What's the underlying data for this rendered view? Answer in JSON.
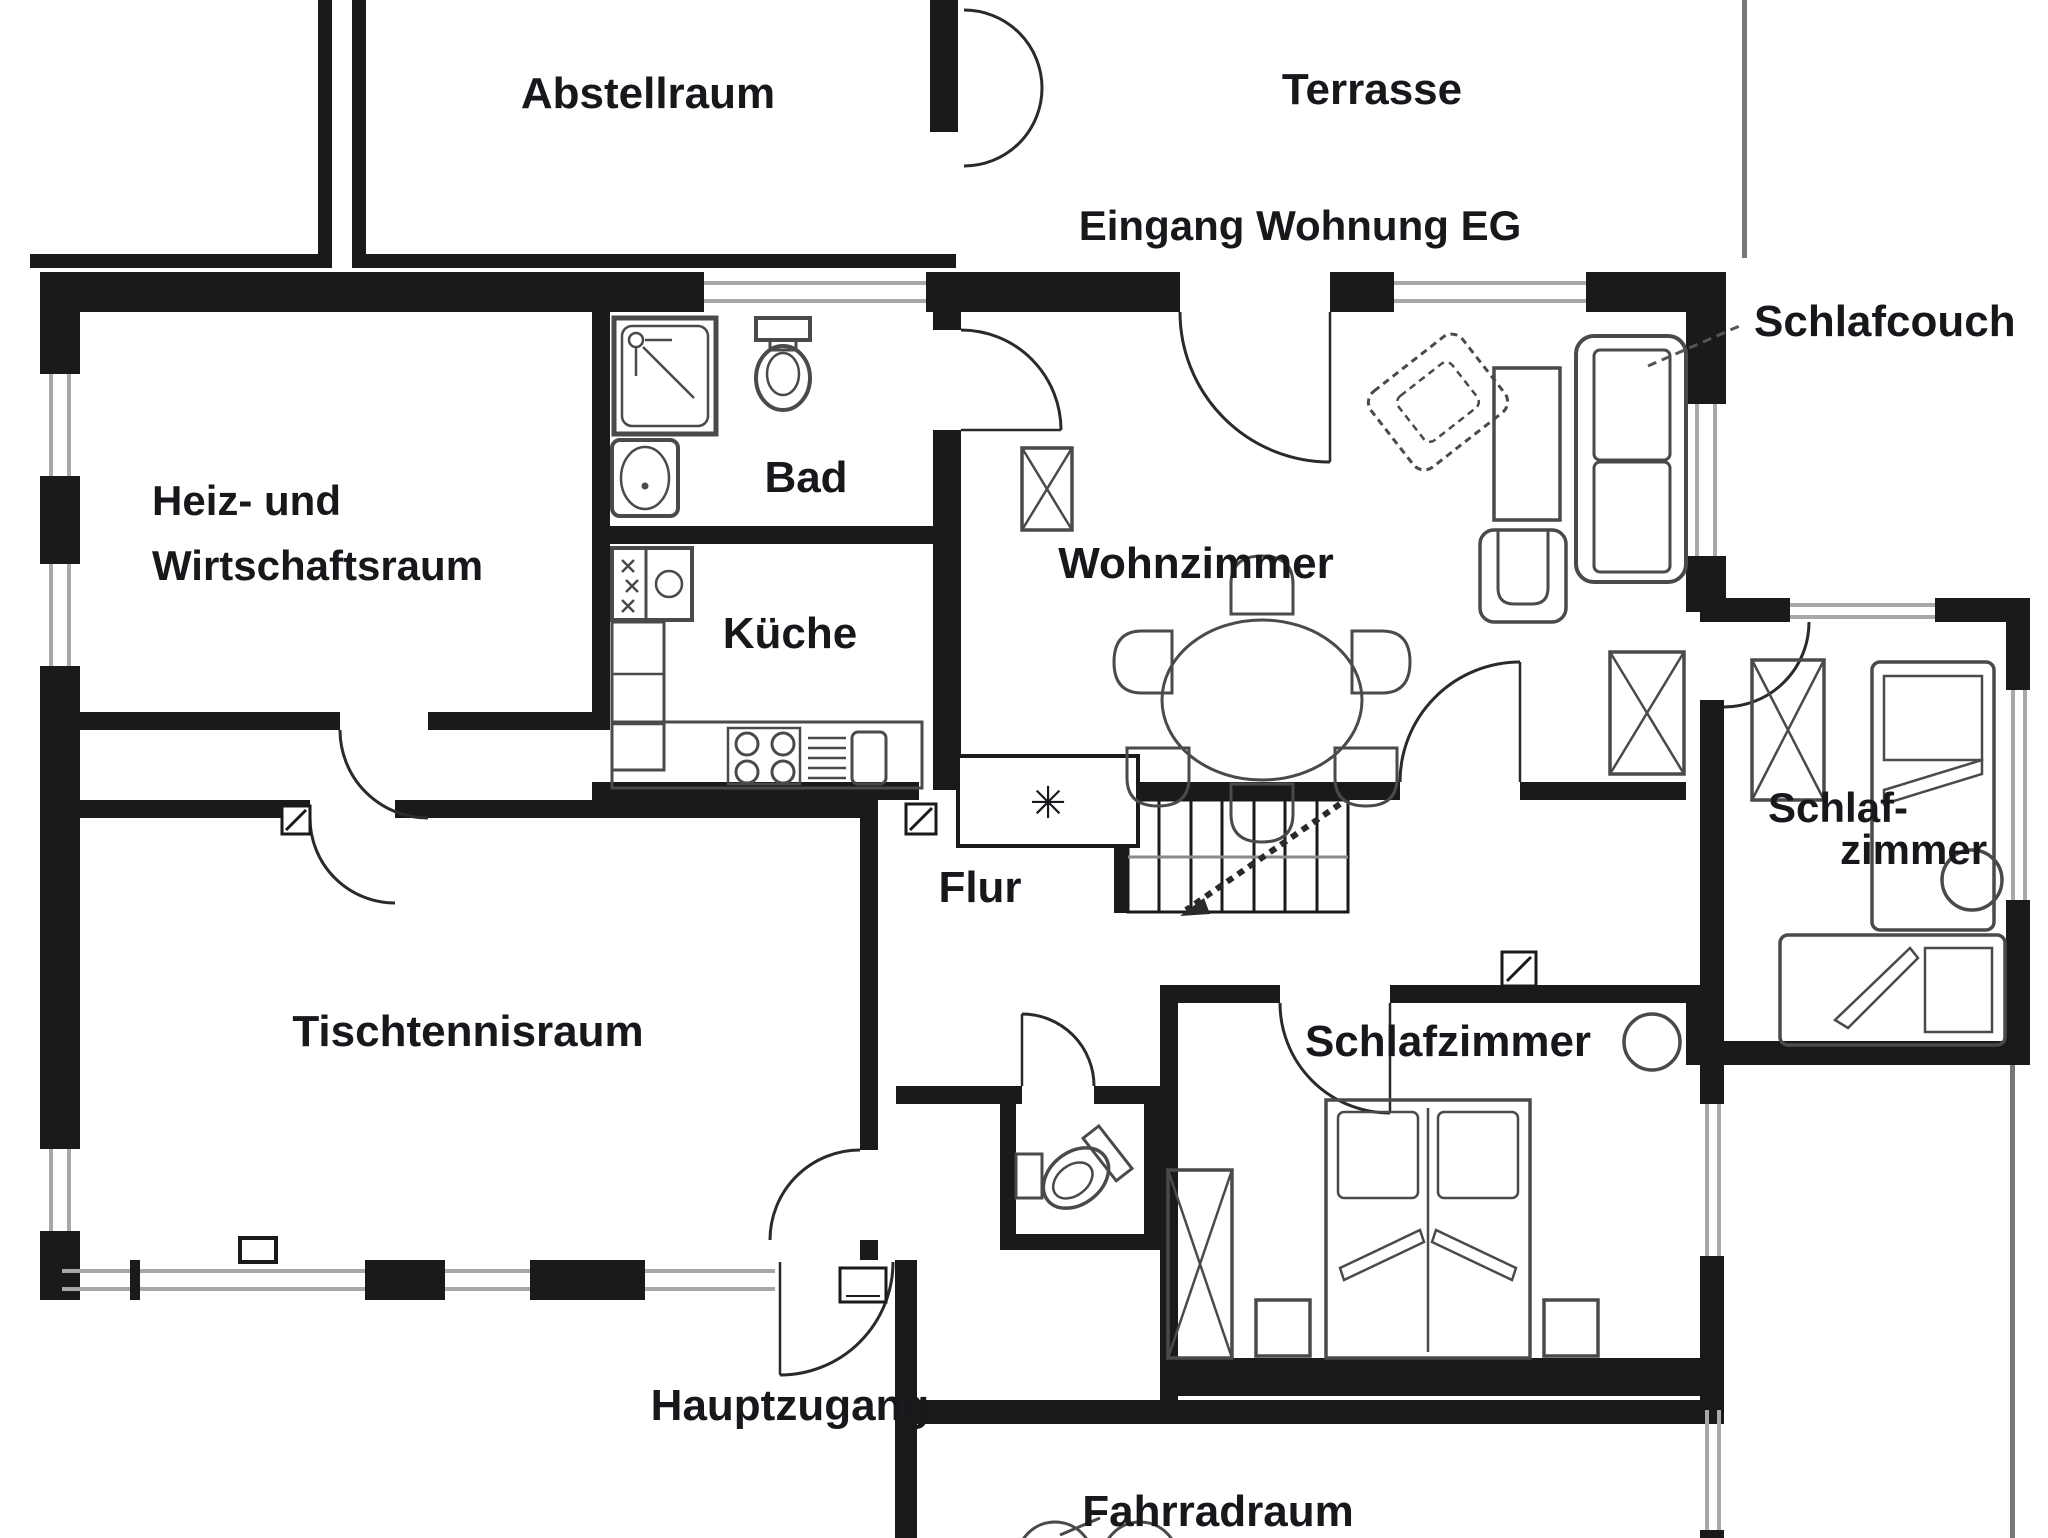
{
  "figure": {
    "type": "floor-plan",
    "background": "#ffffff",
    "wall_color": "#1a1a1a",
    "window_color": "#a8a8a8",
    "furniture_color": "#4a4a4a",
    "text_color": "#17171c"
  },
  "rooms": {
    "abstellraum": {
      "label": "Abstellraum"
    },
    "terrasse": {
      "label": "Terrasse"
    },
    "eingang": {
      "label": "Eingang Wohnung EG"
    },
    "heizraum": {
      "line1": "Heiz- und",
      "line2": "Wirtschaftsraum"
    },
    "bad": {
      "label": "Bad"
    },
    "kueche": {
      "label": "Küche"
    },
    "wohnzimmer": {
      "label": "Wohnzimmer"
    },
    "schlafcouch": {
      "label": "Schlafcouch"
    },
    "schlafzimmer_klein": {
      "line1": "Schlaf-",
      "line2": "zimmer"
    },
    "tischtennisraum": {
      "label": "Tischtennisraum"
    },
    "flur": {
      "label": "Flur"
    },
    "schlafzimmer": {
      "label": "Schlafzimmer"
    },
    "hauptzugang": {
      "label": "Hauptzugang"
    },
    "fahrradraum": {
      "label": "Fahrradraum"
    }
  },
  "symbols": {
    "flue": "✳"
  }
}
